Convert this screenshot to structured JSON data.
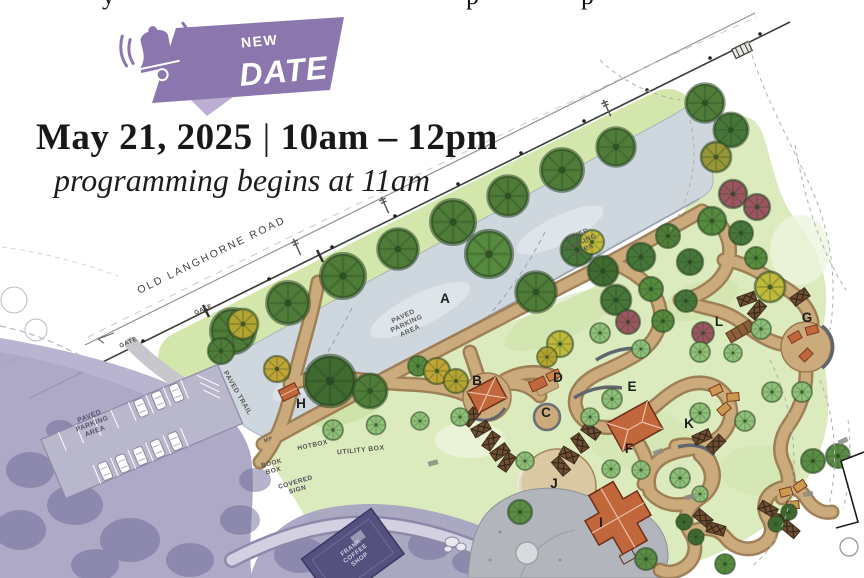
{
  "flyer": {
    "top_fragments": [
      {
        "ch": "y",
        "x": 102
      },
      {
        "ch": "p",
        "x": 466
      },
      {
        "ch": "p",
        "x": 581
      }
    ],
    "badge": {
      "top": "NEW",
      "main": "DATE"
    },
    "headline": {
      "date": "May 21, 2025",
      "separator": "|",
      "time": "10am – 12pm",
      "subtitle": "programming begins at 11am"
    }
  },
  "map": {
    "area_letters": [
      {
        "t": "A",
        "x": 445,
        "y": 303
      },
      {
        "t": "B",
        "x": 477,
        "y": 385
      },
      {
        "t": "C",
        "x": 546,
        "y": 417
      },
      {
        "t": "D",
        "x": 558,
        "y": 382
      },
      {
        "t": "E",
        "x": 632,
        "y": 391
      },
      {
        "t": "F",
        "x": 629,
        "y": 453
      },
      {
        "t": "G",
        "x": 807,
        "y": 322
      },
      {
        "t": "H",
        "x": 301,
        "y": 408
      },
      {
        "t": "I",
        "x": 601,
        "y": 527
      },
      {
        "t": "J",
        "x": 554,
        "y": 488
      },
      {
        "t": "K",
        "x": 689,
        "y": 428
      },
      {
        "t": "L",
        "x": 719,
        "y": 326
      }
    ],
    "labels": [
      {
        "text": "OLD LANGHORNE ROAD",
        "x": 213,
        "y": 258,
        "rot": -26,
        "size": 10.5,
        "ls": 2.2,
        "w": 500,
        "c": "#45433e"
      },
      {
        "text": "GATE",
        "x": 129,
        "y": 344,
        "rot": -24,
        "size": 6.2,
        "c": "#55524b"
      },
      {
        "text": "GATE",
        "x": 204,
        "y": 311,
        "rot": -24,
        "size": 6.2,
        "c": "#55524b"
      },
      {
        "text": "PAVED\nPARKING\nAREA",
        "x": 404,
        "y": 318,
        "rot": -25,
        "size": 6.8,
        "c": "#5c5952"
      },
      {
        "text": "PAVED\nPARKING\nAREA",
        "x": 578,
        "y": 237,
        "rot": -25,
        "size": 6.8,
        "c": "#5c5952"
      },
      {
        "text": "PAVED\nPARKING\nAREA",
        "x": 90,
        "y": 418,
        "rot": -21,
        "size": 6.8,
        "c": "#55526e"
      },
      {
        "text": "PAVED TRAIL",
        "x": 236,
        "y": 394,
        "rot": 60,
        "size": 6.8,
        "c": "#5c5952"
      },
      {
        "text": "MP",
        "x": 269,
        "y": 441,
        "rot": -22,
        "size": 5.5,
        "c": "#5c5952"
      },
      {
        "text": "HOTBOX",
        "x": 313,
        "y": 447,
        "rot": -12,
        "size": 6.5,
        "c": "#55524b"
      },
      {
        "text": "UTILITY BOX",
        "x": 361,
        "y": 452,
        "rot": -6,
        "size": 6.8,
        "c": "#55524b"
      },
      {
        "text": "BOOK\nBOX",
        "x": 272,
        "y": 465,
        "rot": -14,
        "size": 6.5,
        "c": "#55524b"
      },
      {
        "text": "COVERED\nSIGN",
        "x": 296,
        "y": 484,
        "rot": -16,
        "size": 6.5,
        "c": "#4f4c62"
      },
      {
        "text": "FRANK\nCOFFEE\nSHOP",
        "x": 352,
        "y": 549,
        "rot": -37,
        "size": 6.2,
        "c": "#cfccdf"
      }
    ],
    "colors": {
      "badge_purple": "#8b77ad",
      "lawn_green": "#dcebbe",
      "parking_gray": "#ced7de",
      "path_tan": "#cbab7c",
      "roof_red": "#c2663c",
      "existing_wash_purple": "#a6a2c2"
    }
  }
}
